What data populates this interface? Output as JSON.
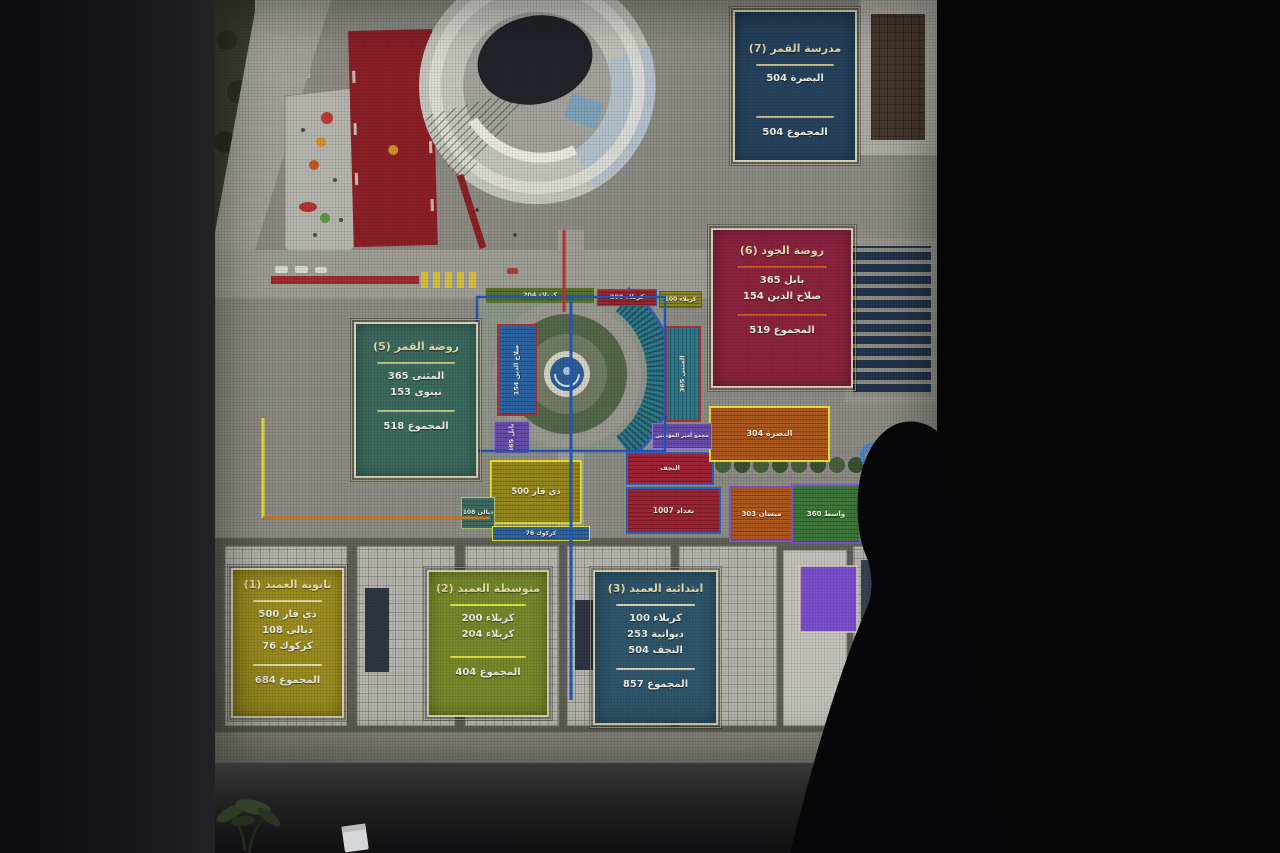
{
  "scene": {
    "description": "Photograph of a projector screen showing an annotated aerial masterplan of the Al-Ameed school campus with student counts per governorate",
    "surface": "projector-screen",
    "foreground": "person-silhouette"
  },
  "legend": {
    "qamar7": {
      "title": "مدرسة القمر (7)",
      "rows": [
        "البصرة 504"
      ],
      "total": "المجموع 504",
      "color": "#26435e"
    },
    "joud6": {
      "title": "روضة الجود (6)",
      "rows": [
        "بابل 365",
        "صلاح الدين 154"
      ],
      "total": "المجموع 519",
      "color": "#8c2340"
    },
    "qamar5": {
      "title": "روضة القمر (5)",
      "rows": [
        "المثنى 365",
        "نينوى 153"
      ],
      "total": "المجموع 518",
      "color": "#3c6a5e"
    },
    "ameed1": {
      "title": "ثانوية العميد (1)",
      "rows": [
        "ذي قار 500",
        "ديالى 108",
        "كركوك 76"
      ],
      "total": "المجموع 684",
      "color": "#9d8d20"
    },
    "ameed2": {
      "title": "متوسطة العميد (2)",
      "rows": [
        "كربلاء 200",
        "كربلاء 204"
      ],
      "total": "المجموع 404",
      "color": "#76892a"
    },
    "ameed3": {
      "title": "ابتدائية العميد (3)",
      "rows": [
        "كربلاء 100",
        "ديوانية 253",
        "النجف 504"
      ],
      "total": "المجموع 857",
      "color": "#2f566b"
    }
  },
  "zones": {
    "karbala204": "كربلاء 204",
    "karbala200": "كربلاء 200",
    "karbala100": "كربلاء 100",
    "salahaldin": "صلاح الدين 154",
    "babil": "بابل 365",
    "muthanna": "المثنى 365",
    "dhiqar": "ذي قار 500",
    "diyala": "ديالى 108",
    "kirkuk": "كركوك 76",
    "najaf": "النجف",
    "baghdad": "بغداد 1007",
    "basra": "البصرة 304",
    "maysan": "ميسان 303",
    "wasit": "واسط 360",
    "complex": "مجمع أمير المؤمنين"
  },
  "colors": {
    "legend_border": "#ded6b4",
    "navy": "#26435e",
    "maroon": "#8c2340",
    "teal": "#3c6a5e",
    "olive": "#9d8d20",
    "green": "#76892a",
    "steel": "#2f566b",
    "purple": "#7b4fd0",
    "route_blue": "#2458b8",
    "route_red": "#c03030",
    "route_yellow": "#e8e437",
    "route_orange": "#c87820"
  }
}
